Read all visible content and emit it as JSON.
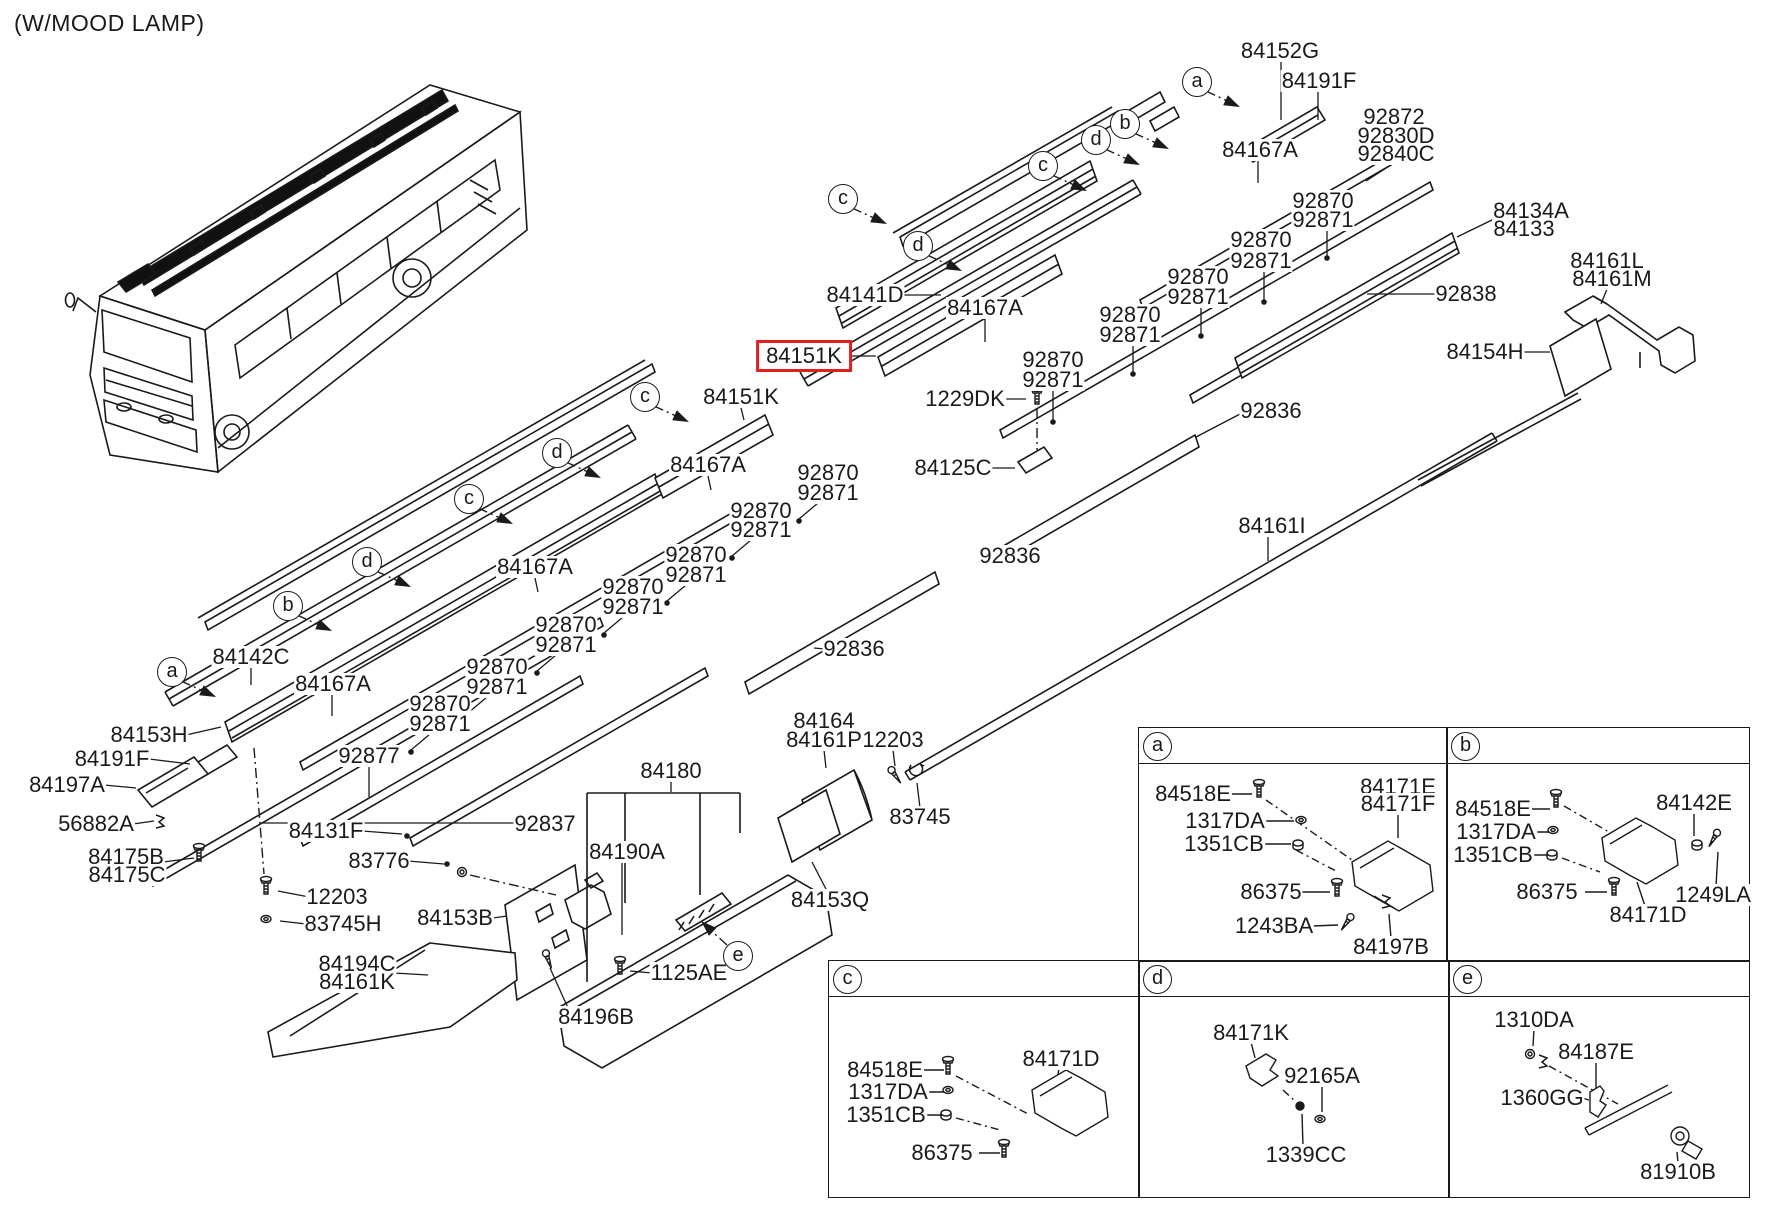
{
  "title": "(W/MOOD LAMP)",
  "colors": {
    "line": "#1a1a1a",
    "highlight": "#e01f1f",
    "background": "#ffffff"
  },
  "highlighted_part": {
    "t": "84151K",
    "x": 804,
    "y": 356
  },
  "part_labels": [
    {
      "t": "84152G",
      "x": 1280,
      "y": 51
    },
    {
      "t": "84191F",
      "x": 1319,
      "y": 81
    },
    {
      "t": "92872",
      "x": 1394,
      "y": 117
    },
    {
      "t": "92830D",
      "x": 1396,
      "y": 136
    },
    {
      "t": "92840C",
      "x": 1396,
      "y": 154
    },
    {
      "t": "84167A",
      "x": 1260,
      "y": 150
    },
    {
      "t": "92870",
      "x": 1323,
      "y": 201
    },
    {
      "t": "92871",
      "x": 1323,
      "y": 220
    },
    {
      "t": "84134A",
      "x": 1531,
      "y": 211
    },
    {
      "t": "84133",
      "x": 1524,
      "y": 229
    },
    {
      "t": "92870",
      "x": 1261,
      "y": 240
    },
    {
      "t": "92871",
      "x": 1261,
      "y": 261
    },
    {
      "t": "84161L",
      "x": 1607,
      "y": 261
    },
    {
      "t": "84161M",
      "x": 1612,
      "y": 279
    },
    {
      "t": "92870",
      "x": 1198,
      "y": 277
    },
    {
      "t": "92871",
      "x": 1198,
      "y": 297
    },
    {
      "t": "84141D",
      "x": 865,
      "y": 295
    },
    {
      "t": "84167A",
      "x": 985,
      "y": 308
    },
    {
      "t": "92838",
      "x": 1466,
      "y": 294
    },
    {
      "t": "92870",
      "x": 1130,
      "y": 315
    },
    {
      "t": "92871",
      "x": 1130,
      "y": 335
    },
    {
      "t": "84154H",
      "x": 1485,
      "y": 352
    },
    {
      "t": "92870",
      "x": 1053,
      "y": 360
    },
    {
      "t": "92871",
      "x": 1053,
      "y": 380
    },
    {
      "t": "1229DK",
      "x": 965,
      "y": 399
    },
    {
      "t": "84151K",
      "x": 741,
      "y": 397
    },
    {
      "t": "92836",
      "x": 1271,
      "y": 411
    },
    {
      "t": "84125C",
      "x": 953,
      "y": 468
    },
    {
      "t": "84167A",
      "x": 708,
      "y": 465
    },
    {
      "t": "92870",
      "x": 828,
      "y": 473
    },
    {
      "t": "92871",
      "x": 828,
      "y": 493
    },
    {
      "t": "92870",
      "x": 761,
      "y": 511
    },
    {
      "t": "92871",
      "x": 761,
      "y": 530
    },
    {
      "t": "84161I",
      "x": 1272,
      "y": 526
    },
    {
      "t": "92836",
      "x": 1010,
      "y": 556
    },
    {
      "t": "84167A",
      "x": 535,
      "y": 567
    },
    {
      "t": "92870",
      "x": 696,
      "y": 555
    },
    {
      "t": "92871",
      "x": 696,
      "y": 575
    },
    {
      "t": "92870",
      "x": 633,
      "y": 587
    },
    {
      "t": "92871",
      "x": 633,
      "y": 607
    },
    {
      "t": "92870",
      "x": 566,
      "y": 625
    },
    {
      "t": "92871",
      "x": 566,
      "y": 645
    },
    {
      "t": "84142C",
      "x": 251,
      "y": 657
    },
    {
      "t": "92870",
      "x": 497,
      "y": 667
    },
    {
      "t": "92871",
      "x": 497,
      "y": 687
    },
    {
      "t": "84167A",
      "x": 333,
      "y": 684
    },
    {
      "t": "92870",
      "x": 440,
      "y": 704
    },
    {
      "t": "92871",
      "x": 440,
      "y": 724
    },
    {
      "t": "92836",
      "x": 854,
      "y": 649
    },
    {
      "t": "84153H",
      "x": 149,
      "y": 735
    },
    {
      "t": "84191F",
      "x": 112,
      "y": 759
    },
    {
      "t": "92877",
      "x": 369,
      "y": 756
    },
    {
      "t": "84180",
      "x": 671,
      "y": 771
    },
    {
      "t": "84197A",
      "x": 67,
      "y": 785
    },
    {
      "t": "84164",
      "x": 824,
      "y": 721
    },
    {
      "t": "84161P",
      "x": 824,
      "y": 740
    },
    {
      "t": "12203",
      "x": 893,
      "y": 740
    },
    {
      "t": "56882A",
      "x": 96,
      "y": 824
    },
    {
      "t": "92837",
      "x": 545,
      "y": 824
    },
    {
      "t": "84131F",
      "x": 326,
      "y": 831
    },
    {
      "t": "83745",
      "x": 920,
      "y": 817
    },
    {
      "t": "84175B",
      "x": 126,
      "y": 857
    },
    {
      "t": "84175C",
      "x": 127,
      "y": 875
    },
    {
      "t": "83776",
      "x": 379,
      "y": 861
    },
    {
      "t": "84190A",
      "x": 627,
      "y": 852
    },
    {
      "t": "84153Q",
      "x": 830,
      "y": 900
    },
    {
      "t": "12203",
      "x": 337,
      "y": 897
    },
    {
      "t": "83745H",
      "x": 343,
      "y": 924
    },
    {
      "t": "84153B",
      "x": 455,
      "y": 918
    },
    {
      "t": "84194C",
      "x": 357,
      "y": 964
    },
    {
      "t": "84161K",
      "x": 357,
      "y": 982
    },
    {
      "t": "1125AE",
      "x": 689,
      "y": 973
    },
    {
      "t": "84196B",
      "x": 596,
      "y": 1017
    }
  ],
  "callouts": [
    {
      "l": "a",
      "x": 1197,
      "y": 82
    },
    {
      "l": "b",
      "x": 1125,
      "y": 124
    },
    {
      "l": "d",
      "x": 1096,
      "y": 140
    },
    {
      "l": "c",
      "x": 1043,
      "y": 166
    },
    {
      "l": "c",
      "x": 843,
      "y": 199
    },
    {
      "l": "d",
      "x": 918,
      "y": 246
    },
    {
      "l": "c",
      "x": 645,
      "y": 397
    },
    {
      "l": "d",
      "x": 557,
      "y": 453
    },
    {
      "l": "c",
      "x": 469,
      "y": 499
    },
    {
      "l": "d",
      "x": 367,
      "y": 562
    },
    {
      "l": "b",
      "x": 288,
      "y": 606
    },
    {
      "l": "a",
      "x": 172,
      "y": 672
    },
    {
      "l": "e",
      "x": 738,
      "y": 956
    }
  ],
  "panels": [
    {
      "letter": "a",
      "x": 1138,
      "y": 727,
      "w": 308,
      "h": 233,
      "items": [
        {
          "t": "84518E",
          "x": 1193,
          "y": 794
        },
        {
          "t": "1317DA",
          "x": 1225,
          "y": 821
        },
        {
          "t": "1351CB",
          "x": 1224,
          "y": 844
        },
        {
          "t": "86375",
          "x": 1271,
          "y": 892
        },
        {
          "t": "1243BA",
          "x": 1274,
          "y": 926
        },
        {
          "t": "84197B",
          "x": 1391,
          "y": 947
        },
        {
          "t": "84171E",
          "x": 1398,
          "y": 787
        },
        {
          "t": "84171F",
          "x": 1398,
          "y": 804
        }
      ]
    },
    {
      "letter": "b",
      "x": 1446,
      "y": 727,
      "w": 302,
      "h": 233,
      "items": [
        {
          "t": "84518E",
          "x": 1493,
          "y": 809
        },
        {
          "t": "1317DA",
          "x": 1496,
          "y": 832
        },
        {
          "t": "1351CB",
          "x": 1493,
          "y": 855
        },
        {
          "t": "86375",
          "x": 1547,
          "y": 892
        },
        {
          "t": "84171D",
          "x": 1648,
          "y": 915
        },
        {
          "t": "84142E",
          "x": 1694,
          "y": 803
        },
        {
          "t": "1249LA",
          "x": 1713,
          "y": 895
        }
      ]
    },
    {
      "letter": "c",
      "x": 828,
      "y": 960,
      "w": 310,
      "h": 236,
      "items": [
        {
          "t": "84518E",
          "x": 885,
          "y": 1070
        },
        {
          "t": "1317DA",
          "x": 888,
          "y": 1092
        },
        {
          "t": "1351CB",
          "x": 886,
          "y": 1115
        },
        {
          "t": "86375",
          "x": 942,
          "y": 1153
        },
        {
          "t": "84171D",
          "x": 1061,
          "y": 1059
        }
      ]
    },
    {
      "letter": "d",
      "x": 1138,
      "y": 960,
      "w": 310,
      "h": 236,
      "items": [
        {
          "t": "84171K",
          "x": 1251,
          "y": 1033
        },
        {
          "t": "92165A",
          "x": 1322,
          "y": 1076
        },
        {
          "t": "1339CC",
          "x": 1306,
          "y": 1155
        }
      ]
    },
    {
      "letter": "e",
      "x": 1448,
      "y": 960,
      "w": 300,
      "h": 236,
      "items": [
        {
          "t": "1310DA",
          "x": 1534,
          "y": 1020
        },
        {
          "t": "84187E",
          "x": 1596,
          "y": 1052
        },
        {
          "t": "1360GG",
          "x": 1542,
          "y": 1098
        },
        {
          "t": "81910B",
          "x": 1678,
          "y": 1172
        }
      ]
    }
  ]
}
